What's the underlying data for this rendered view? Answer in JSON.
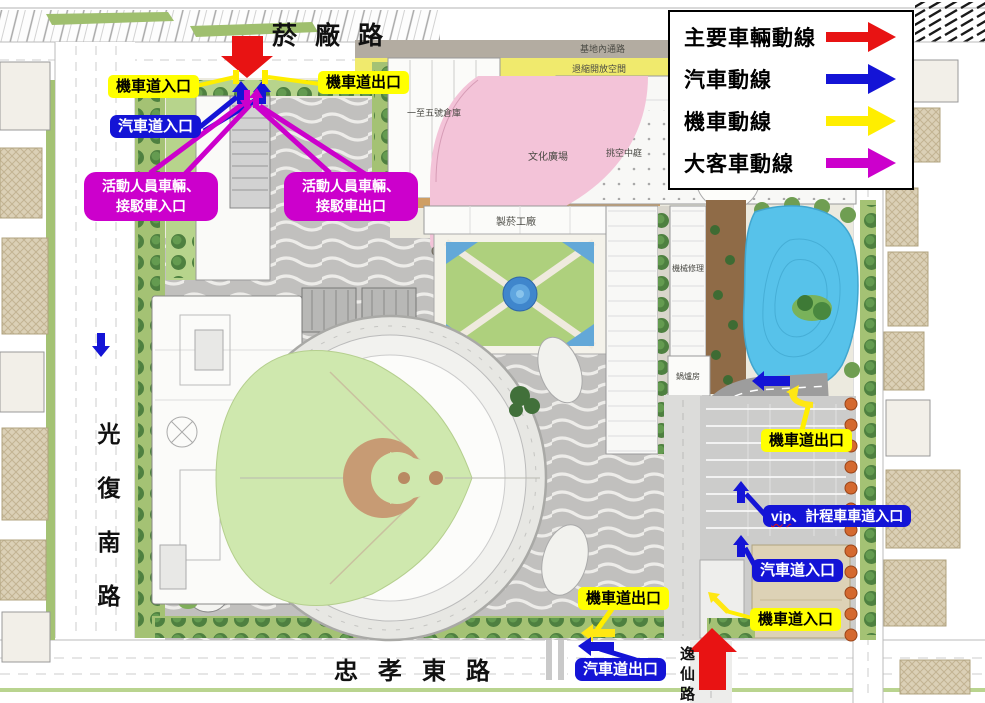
{
  "legend": {
    "items": [
      {
        "id": "main-vehicle",
        "label": "主要車輛動線",
        "color": "#e81313"
      },
      {
        "id": "car",
        "label": "汽車動線",
        "color": "#1414d6"
      },
      {
        "id": "motorcycle",
        "label": "機車動線",
        "color": "#ffee00"
      },
      {
        "id": "bus",
        "label": "大客車動線",
        "color": "#cc00cc"
      }
    ]
  },
  "roads": {
    "north": "菸廠路",
    "west": "光復南路",
    "south": "忠孝東路",
    "southeast": "逸仙路"
  },
  "site_labels": {
    "internal_road": "基地內通路",
    "setback_space": "退縮開放空間",
    "warehouses": "一至五號倉庫",
    "culture_plaza": "文化廣場",
    "atrium": "挑空中庭",
    "tobacco_factory": "製菸工廠",
    "machine_repair": "機械修理",
    "boiler_room": "鍋爐房"
  },
  "callouts": {
    "top_moto_in": "機車道入口",
    "top_moto_out": "機車道出口",
    "top_car_in": "汽車道入口",
    "top_bus_in_line1": "活動人員車輛、",
    "top_bus_in_line2": "接駁車入口",
    "top_bus_out_line1": "活動人員車輛、",
    "top_bus_out_line2": "接駁車出口",
    "east_moto_out": "機車道出口",
    "east_vip_prefix": "vip",
    "east_vip_rest": "、計程車車道入口",
    "east_car_in": "汽車道入口",
    "east_moto_in": "機車道入口",
    "south_moto_out": "機車道出口",
    "south_car_out": "汽車道出口"
  }
}
